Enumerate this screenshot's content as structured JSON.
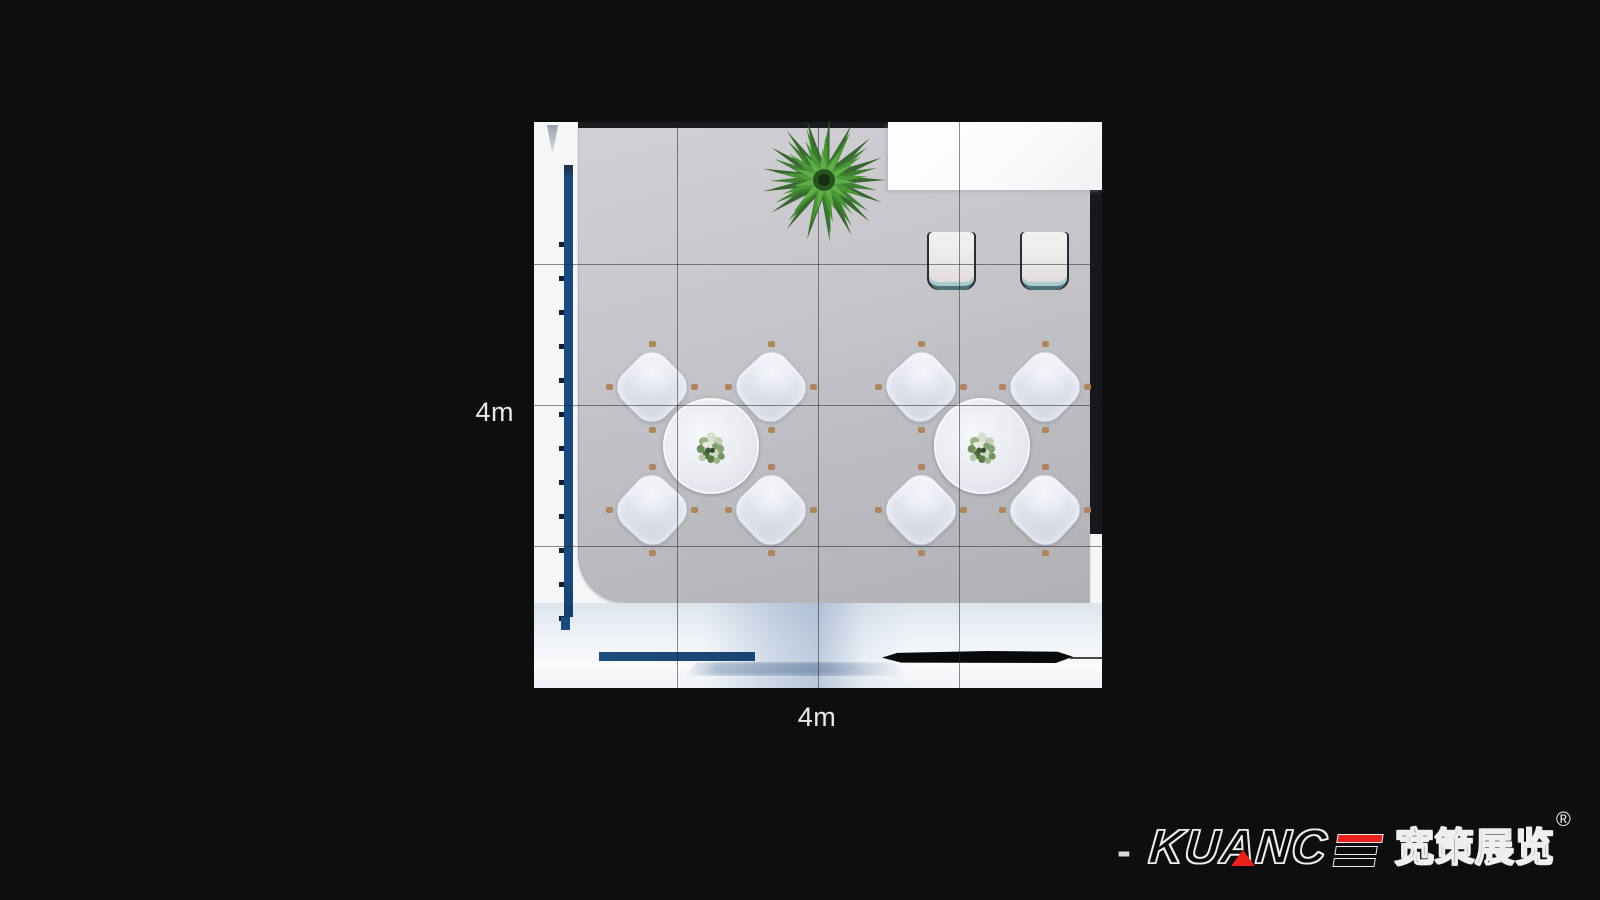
{
  "dimensions": {
    "width_label": "4m",
    "height_label": "4m"
  },
  "branding": {
    "dash": "-",
    "name_full": "KUANCE",
    "name_prefix": "KUANC",
    "cn_name": "宽策展览",
    "registered_mark": "®",
    "accent_red": "#e8211d"
  },
  "colors": {
    "background": "#0e0e0f",
    "floor_gray": "#c4c4c8",
    "wall_blue": "#1b4b7e",
    "bottom_bar_blue": "#1c4876",
    "screen_black": "#0a0a0b",
    "counter_white": "#fbfbfc",
    "grid_line": "#24272d",
    "label_text": "#e8e8e8"
  },
  "furniture": {
    "plant": "potted-palm-plant",
    "reception_counter": "white-counter",
    "stools": [
      "stool",
      "stool"
    ],
    "dining_sets": [
      {
        "table": "round-table",
        "centerpiece": "flower-bouquet",
        "chairs": 4
      },
      {
        "table": "round-table",
        "centerpiece": "flower-bouquet",
        "chairs": 4
      }
    ],
    "display_wall": "blue-display-wall",
    "water_bar": "blue-bar",
    "screen": "black-screen-bar"
  }
}
